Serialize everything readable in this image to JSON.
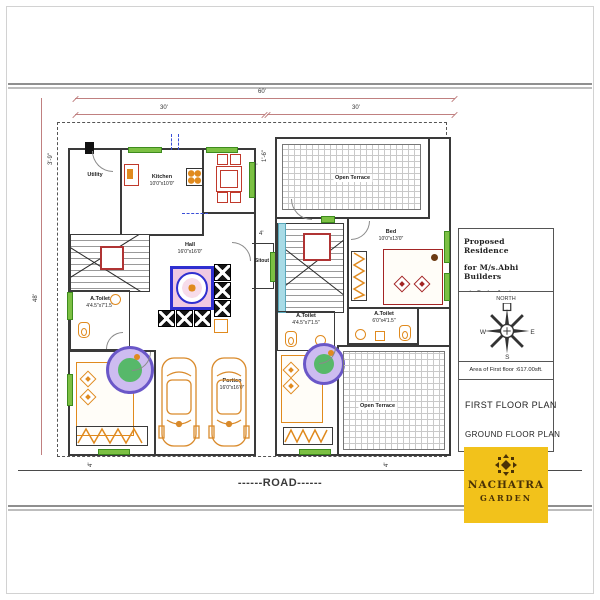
{
  "colors": {
    "wall": "#3a3a3a",
    "dim": "#c08080",
    "window": "#7cc043",
    "fixture": "#e08a1e",
    "stair": "#b03434",
    "ceiling_blue": "#2f2fd0",
    "ceiling_pink": "#f0c9e2",
    "fan_purple": "#6a57c8",
    "fan_green": "#57b86a"
  },
  "dims": {
    "total": "60'",
    "left_half": "30'",
    "right_half": "30'",
    "depth": "48'",
    "setback_left": "3'-9\"",
    "gap_left": "2'",
    "gap_right": "2'",
    "side": "1'-6\"",
    "sitout_width": "4'",
    "tick_bottom_left": "4'",
    "tick_bottom_right": "4'"
  },
  "ground_floor": {
    "utility": {
      "name": "Utility"
    },
    "kitchen": {
      "name": "Kitchen",
      "size": "10'0\"x10'0\""
    },
    "dining": {
      "name": "Dining",
      "size": "8'0\"x10'0\""
    },
    "hall": {
      "name": "Hall",
      "size": "16'0\"x16'0\""
    },
    "a_toilet": {
      "name": "A.Toilet",
      "size": "4'4.5\"x7'1.5\""
    },
    "m_bed": {
      "name": "M.Bed",
      "size": "10'0\"X16'0\""
    },
    "portico": {
      "name": "Portico",
      "size": "16'0\"x16'0\""
    },
    "sitout": {
      "name": "Sitout"
    }
  },
  "first_floor": {
    "terrace_top": {
      "name": "Open Terrace"
    },
    "bed": {
      "name": "Bed",
      "size": "10'0\"x13'0\""
    },
    "a_toilet_left": {
      "name": "A.Toilet",
      "size": "4'4.5\"x7'1.5\""
    },
    "a_toilet_right": {
      "name": "A.Toilet",
      "size": "6'0\"x4'1.5\""
    },
    "m_bed": {
      "name": "M.Bed",
      "size": "10'0\"X13'0\""
    },
    "terrace_bottom": {
      "name": "Open Terrace"
    }
  },
  "road": {
    "label": "------ROAD------"
  },
  "title_block": {
    "project_lines": [
      "Proposed Residence",
      "for M/s.Abhi Builders",
      "at Coimbatore."
    ],
    "compass": {
      "north": "NORTH",
      "west": "W",
      "east": "E",
      "south": "S"
    },
    "area_note": "Area of First floor :617.00sft.",
    "plan_primary": "FIRST  FLOOR PLAN",
    "plan_secondary": "GROUND  FLOOR PLAN"
  },
  "logo": {
    "name": "NACHATRA",
    "subtitle": "GARDEN",
    "background": "#F2C21B",
    "text_color": "#4A3206"
  }
}
